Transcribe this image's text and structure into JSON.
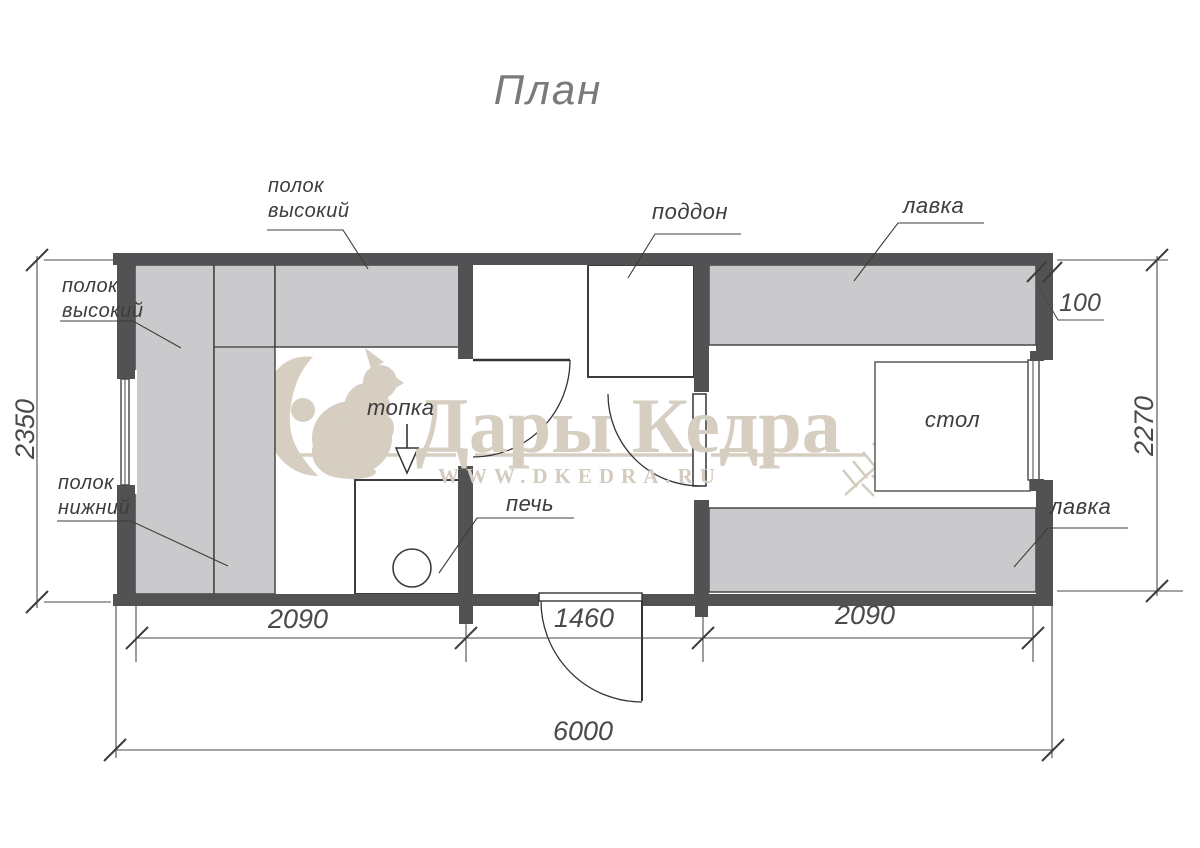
{
  "title": "План",
  "watermark": {
    "brand": "Дары Кедра",
    "site": "WWW.DKEDRA.RU"
  },
  "labels": {
    "shelf_high_top_1": "полок",
    "shelf_high_top_2": "высокий",
    "shelf_high_left_1": "полок",
    "shelf_high_left_2": "высокий",
    "shelf_low_1": "полок",
    "shelf_low_2": "нижний",
    "tray": "поддон",
    "bench_top": "лавка",
    "bench_bottom": "лавка",
    "firebox": "топка",
    "stove": "печь",
    "table": "стол"
  },
  "dimensions": {
    "left_room_width": "2090",
    "middle_room_width": "1460",
    "right_room_width": "2090",
    "total_width": "6000",
    "left_height": "2350",
    "right_height": "2270",
    "wall_thickness": "100"
  },
  "colors": {
    "wall": "#525254",
    "furniture": "#cacacc",
    "linework": "#3c3c3c",
    "watermark": "#d5cec1"
  }
}
